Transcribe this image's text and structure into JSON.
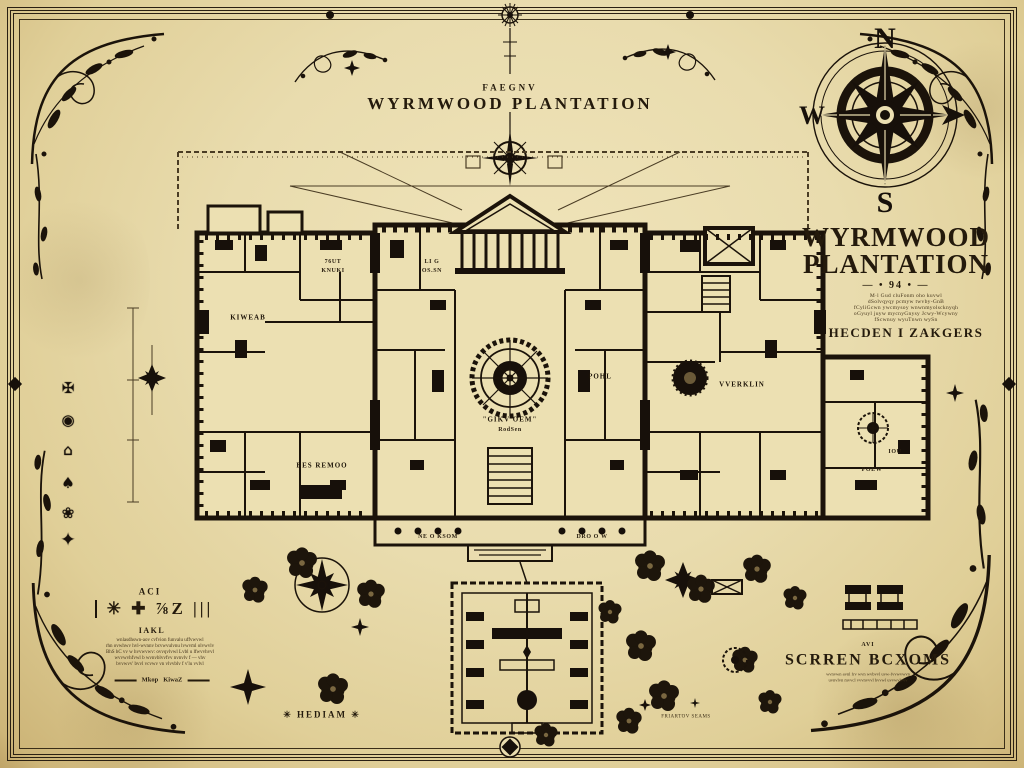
{
  "colors": {
    "parchment": "#e9dcae",
    "ink": "#1b130a",
    "faded_ink": "#4a3c24"
  },
  "page": {
    "caption": "FAEGNV",
    "title": "WYRMWOOD PLANTATION"
  },
  "compass": {
    "north": "N",
    "west": "W",
    "south": "S",
    "east_icon": "arrow"
  },
  "title_block": {
    "line1": "WYRMWOOD",
    "line2": "PLANTATION",
    "divider": "— • 94 • —",
    "notes": [
      "M·l Gud cluFonm oho kuvwl",
      "dSolvqyqy pcmyw twvby-GnB",
      "fCyliGcwn ywcmysoy wnwnmyolscknyqh",
      "oGyuyl juyw mycnyGnysy Jcwy-Wcywny",
      "fScwnuy wyuTnwn wySn"
    ],
    "subtitle": "HECDEN I ZAKGERS"
  },
  "rooms": {
    "center": {
      "label": "\"GIKV OEM\"",
      "sub": "RodSen"
    },
    "verklin": {
      "label": "VVERKLIN"
    },
    "pohl": {
      "label": "POHL"
    },
    "kiweab": {
      "label": "KIWEAB"
    },
    "up_left": {
      "label": "76UT",
      "sub": "KNUKI"
    },
    "up_mid": {
      "label": "LI G",
      "sub": "OS.SN"
    },
    "low_left": {
      "label": "BES REMOO"
    },
    "right_a": {
      "label": "IOU"
    },
    "right_b": {
      "label": "POEW"
    },
    "porch_l": {
      "label": "NE O KSOM"
    },
    "porch_r": {
      "label": "DRO O W"
    }
  },
  "legend": {
    "heading": "ACI",
    "symbols": "✳ ✚ ⅞Z |||",
    "sub_heading": "IAKL",
    "notes": [
      "wnlasdhswn-aov cvfvion funvalu uffvwvwl",
      "rhn ovwhwv hvl-wvnnv bcvwvulvnu lvwvml olvwvlv",
      "BhS hC vv w hvvwvwv: ovvqvlvwl Lvbl u lfwvvhvvl",
      "wvvwvhfvwl b wvnvblvvfvv nvnvlv f — vhv",
      "bvvwvv' bvvl vcvwv vn vlvvblv f v'lu vvlvl"
    ],
    "scale_left": "Mkop",
    "scale_right": "KiwaZ",
    "caption": "✳  HEDIAM  ✳"
  },
  "secret_rooms": {
    "caption": "AVI",
    "title": "SCRREN BCXOMS",
    "notes": [
      "wvnvwn avnl frv wvn wvbvvl uvw-fvvwvwvn",
      "uvnvlvn mvvcl vvvnvvvl bvvwl uvvwvlvvv"
    ]
  },
  "footer_note": "FRIARTOV SEAMS",
  "emblems": [
    "✠",
    "◉",
    "⌂",
    "♠",
    "❀",
    "✦"
  ]
}
